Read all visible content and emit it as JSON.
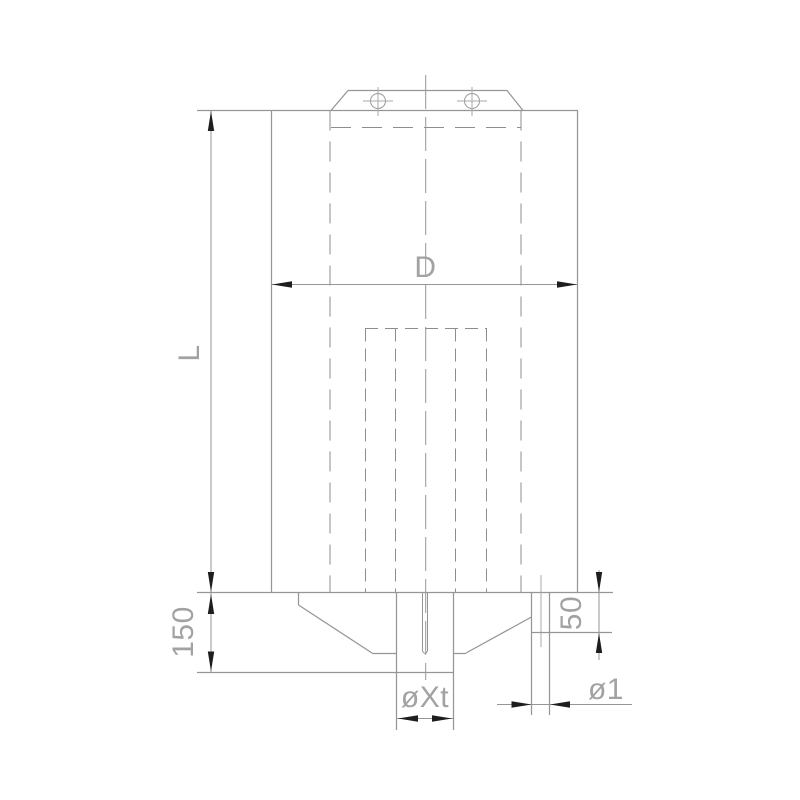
{
  "colors": {
    "bg": "#ffffff",
    "line": "#969696",
    "dash": "#8d8d8d",
    "thin": "#a8a8a8",
    "arrow": "#1e1e1e",
    "text": "#a2a2a2"
  },
  "labels": {
    "overall_length": "L",
    "body_diameter": "D",
    "base_height": "150",
    "side_outlet_height": "50",
    "center_outlet_diameter": "øXt",
    "side_outlet_diameter": "ø1"
  }
}
